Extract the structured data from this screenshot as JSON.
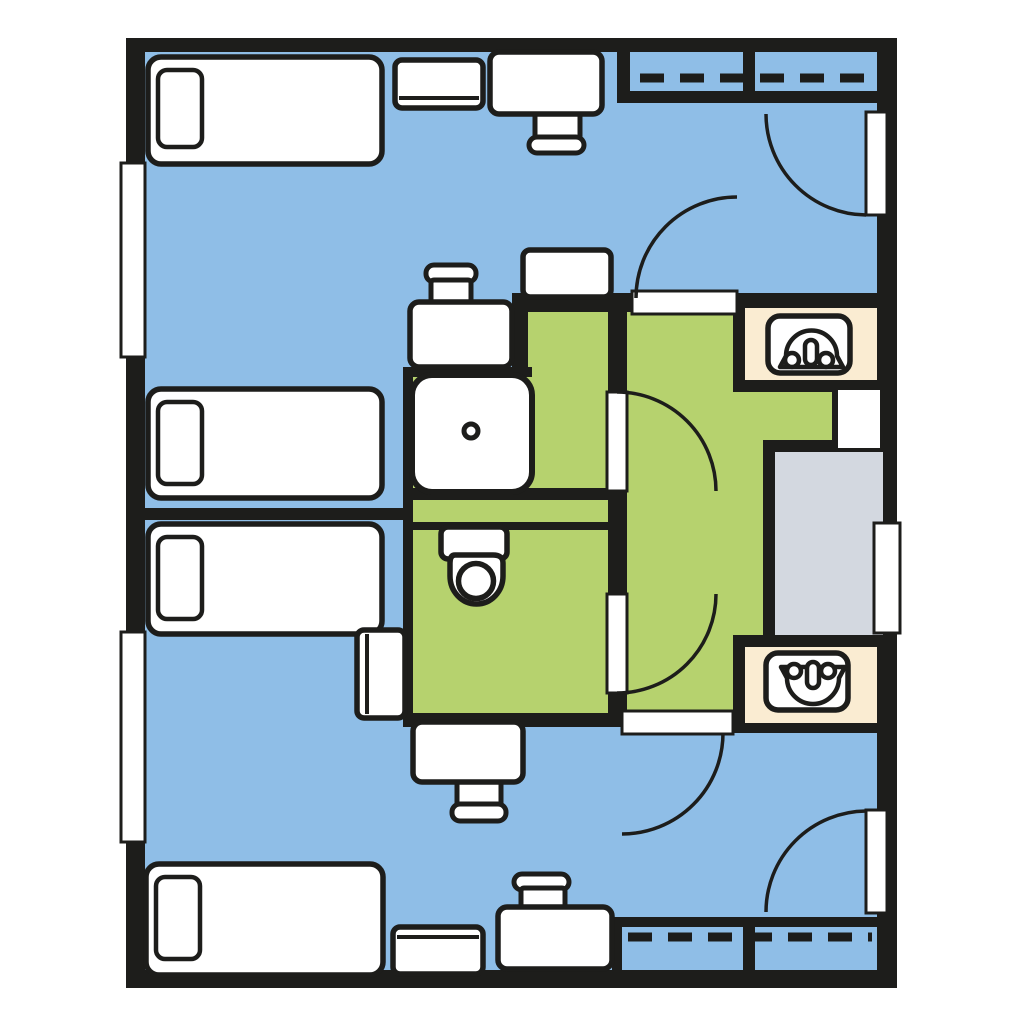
{
  "floor_plan": {
    "canvas": {
      "width": 1024,
      "height": 1024,
      "background": "#ffffff"
    },
    "colors": {
      "wall": "#1d1d1b",
      "bedroom": "#8fbee7",
      "bathroom": "#b6d26e",
      "vanity": "#faecd2",
      "shower_room": "#d3d8e0",
      "fixture": "#ffffff"
    },
    "floors": [
      {
        "name": "floor-bedroom-top-main",
        "color": "bedroom",
        "rect": [
          145,
          52,
          732,
          241
        ]
      },
      {
        "name": "floor-bedroom-top-left",
        "color": "bedroom",
        "rect": [
          145,
          293,
          258,
          215
        ]
      },
      {
        "name": "floor-bedroom-top-desk-nook",
        "color": "bedroom",
        "rect": [
          403,
          293,
          109,
          84
        ]
      },
      {
        "name": "floor-bedroom-bottom-left",
        "color": "bedroom",
        "rect": [
          145,
          520,
          258,
          193
        ]
      },
      {
        "name": "floor-bedroom-bottom-main",
        "color": "bedroom",
        "rect": [
          145,
          713,
          732,
          257
        ]
      },
      {
        "name": "floor-shower-room-green",
        "color": "bathroom",
        "rect": [
          528,
          312,
          99,
          180
        ]
      },
      {
        "name": "floor-shower-niche",
        "color": "bathroom",
        "rect": [
          408,
          377,
          124,
          115
        ]
      },
      {
        "name": "floor-plumbing-chase-strip",
        "color": "bathroom",
        "rect": [
          403,
          500,
          224,
          22
        ]
      },
      {
        "name": "floor-toilet-room",
        "color": "bathroom",
        "rect": [
          403,
          530,
          224,
          183
        ]
      },
      {
        "name": "floor-vestibule",
        "color": "bathroom",
        "rect": [
          627,
          303,
          250,
          410
        ]
      }
    ],
    "frames": [
      {
        "name": "vanity-top-frame",
        "rect": [
          733,
          296,
          164,
          96
        ]
      },
      {
        "name": "vanity-bottom-frame",
        "rect": [
          733,
          635,
          164,
          98
        ]
      },
      {
        "name": "shower-room-frame",
        "rect": [
          763,
          440,
          134,
          207
        ]
      }
    ],
    "walls": [
      {
        "name": "wall-top",
        "rect": [
          126,
          38,
          771,
          14
        ]
      },
      {
        "name": "wall-bottom",
        "rect": [
          126,
          970,
          771,
          18
        ]
      },
      {
        "name": "wall-left",
        "rect": [
          126,
          38,
          19,
          950
        ]
      },
      {
        "name": "wall-right",
        "rect": [
          877,
          38,
          20,
          950
        ]
      },
      {
        "name": "wall-closet-top-side",
        "rect": [
          617,
          45,
          13,
          58
        ]
      },
      {
        "name": "wall-closet-top-front",
        "rect": [
          617,
          91,
          260,
          12
        ]
      },
      {
        "name": "wall-closet-top-divider",
        "rect": [
          743,
          45,
          12,
          58
        ]
      },
      {
        "name": "wall-bath-north-left",
        "rect": [
          512,
          293,
          120,
          19
        ]
      },
      {
        "name": "wall-bath-north-right",
        "rect": [
          737,
          293,
          140,
          19
        ]
      },
      {
        "name": "wall-desk-nook",
        "rect": [
          512,
          293,
          16,
          84
        ]
      },
      {
        "name": "wall-shower-niche-north",
        "rect": [
          403,
          367,
          129,
          10
        ]
      },
      {
        "name": "wall-bath-west",
        "rect": [
          403,
          367,
          10,
          360
        ]
      },
      {
        "name": "wall-suite-divider",
        "rect": [
          126,
          508,
          287,
          12
        ]
      },
      {
        "name": "wall-chase-north",
        "rect": [
          403,
          488,
          224,
          12
        ]
      },
      {
        "name": "wall-chase-south",
        "rect": [
          403,
          522,
          224,
          8
        ]
      },
      {
        "name": "wall-bath-east-upper",
        "rect": [
          608,
          312,
          19,
          80
        ]
      },
      {
        "name": "wall-bath-east-mid",
        "rect": [
          608,
          490,
          19,
          105
        ]
      },
      {
        "name": "wall-bath-east-lower",
        "rect": [
          608,
          692,
          19,
          21
        ]
      },
      {
        "name": "wall-bath-south",
        "rect": [
          403,
          713,
          219,
          14
        ]
      },
      {
        "name": "wall-closet-bottom-side",
        "rect": [
          612,
          917,
          10,
          53
        ]
      },
      {
        "name": "wall-closet-bottom-front",
        "rect": [
          612,
          917,
          265,
          10
        ]
      },
      {
        "name": "wall-closet-bottom-divider",
        "rect": [
          743,
          917,
          12,
          53
        ]
      },
      {
        "name": "wall-shower-entry-edge",
        "rect": [
          832,
          388,
          6,
          62
        ]
      }
    ],
    "insets": [
      {
        "name": "vanity-top-counter",
        "color": "vanity",
        "rect": [
          745,
          308,
          132,
          72
        ]
      },
      {
        "name": "vanity-bottom-counter",
        "color": "vanity",
        "rect": [
          745,
          647,
          132,
          76
        ]
      },
      {
        "name": "shower-room-floor",
        "color": "shower_room",
        "rect": [
          775,
          452,
          108,
          183
        ]
      }
    ],
    "openings": [
      {
        "name": "window-left-upper",
        "rect": [
          121,
          163,
          24,
          194
        ],
        "sw": 3
      },
      {
        "name": "window-left-lower",
        "rect": [
          121,
          632,
          24,
          210
        ],
        "sw": 3
      },
      {
        "name": "window-right",
        "rect": [
          874,
          523,
          26,
          110
        ],
        "sw": 3
      },
      {
        "name": "entry-door-top-gap",
        "rect": [
          866,
          112,
          21,
          103
        ],
        "sw": 3
      },
      {
        "name": "entry-door-bottom-gap",
        "rect": [
          866,
          810,
          21,
          103
        ],
        "sw": 3
      },
      {
        "name": "doorway-top-bedroom",
        "rect": [
          632,
          291,
          105,
          23
        ],
        "sw": 3
      },
      {
        "name": "doorway-bottom-bedroom",
        "rect": [
          622,
          711,
          111,
          23
        ],
        "sw": 3
      },
      {
        "name": "door-leaf-shower-room",
        "rect": [
          607,
          392,
          20,
          99
        ],
        "sw": 3
      },
      {
        "name": "door-leaf-toilet-room",
        "rect": [
          607,
          594,
          20,
          99
        ],
        "sw": 3
      },
      {
        "name": "shower-room-entry",
        "rect": [
          838,
          390,
          42,
          58
        ],
        "sw": 0
      }
    ],
    "door_arcs": [
      {
        "name": "arc-entry-door-top",
        "d": "M 766 114 A 101 101 0 0 0 866 215"
      },
      {
        "name": "arc-top-bedroom-door",
        "d": "M 737 197 A 101 101 0 0 0 636 298"
      },
      {
        "name": "arc-shower-room-door",
        "d": "M 617 392 A 99 99 0 0 1 716 491"
      },
      {
        "name": "arc-toilet-room-door",
        "d": "M 617 693 A 99 99 0 0 0 716 594"
      },
      {
        "name": "arc-bottom-bedroom-door",
        "d": "M 723 733 A 101 101 0 0 1 622 834"
      },
      {
        "name": "arc-entry-door-bottom",
        "d": "M 766 912 A 101 101 0 0 1 866 811"
      }
    ],
    "closet_rods": [
      {
        "name": "closet-rod-top",
        "x1": 640,
        "y1": 78,
        "x2": 872,
        "y2": 78
      },
      {
        "name": "closet-rod-bottom",
        "x1": 628,
        "y1": 937,
        "x2": 872,
        "y2": 937
      }
    ],
    "furniture": [
      {
        "name": "bed-1",
        "rect": [
          148,
          57,
          234,
          107
        ],
        "rx": 13
      },
      {
        "name": "bed-1-pillow",
        "rect": [
          158,
          70,
          44,
          77
        ],
        "rx": 9,
        "sw": 4.5
      },
      {
        "name": "bed-2",
        "rect": [
          148,
          389,
          234,
          109
        ],
        "rx": 13
      },
      {
        "name": "bed-2-pillow",
        "rect": [
          158,
          402,
          44,
          82
        ],
        "rx": 9,
        "sw": 4.5
      },
      {
        "name": "bed-3",
        "rect": [
          148,
          524,
          234,
          110
        ],
        "rx": 13
      },
      {
        "name": "bed-3-pillow",
        "rect": [
          158,
          537,
          44,
          82
        ],
        "rx": 9,
        "sw": 4.5
      },
      {
        "name": "bed-4",
        "rect": [
          146,
          864,
          237,
          111
        ],
        "rx": 13
      },
      {
        "name": "bed-4-pillow",
        "rect": [
          156,
          877,
          44,
          82
        ],
        "rx": 9,
        "sw": 4.5
      },
      {
        "name": "table-top-wall",
        "rect": [
          395,
          60,
          88,
          48
        ],
        "rx": 7,
        "edge": "bottom"
      },
      {
        "name": "chair-desk-top-seat",
        "rect": [
          535,
          112,
          45,
          27
        ],
        "rx": 3,
        "sw": 5
      },
      {
        "name": "desk-top-wall",
        "rect": [
          490,
          52,
          112,
          62
        ],
        "rx": 9
      },
      {
        "name": "chair-desk-top-back",
        "rect": [
          529,
          137,
          55,
          16
        ],
        "rx": 8,
        "sw": 5
      },
      {
        "name": "dresser-mid-top",
        "rect": [
          523,
          250,
          88,
          47
        ],
        "rx": 7
      },
      {
        "name": "chair-desk-nook-top-back",
        "rect": [
          426,
          265,
          50,
          17
        ],
        "rx": 8,
        "sw": 5
      },
      {
        "name": "chair-desk-nook-top-seat",
        "rect": [
          431,
          280,
          40,
          25
        ],
        "rx": 3,
        "sw": 5
      },
      {
        "name": "desk-nook-top",
        "rect": [
          410,
          302,
          102,
          65
        ],
        "rx": 9
      },
      {
        "name": "nightstand-mid-bottom",
        "rect": [
          357,
          630,
          48,
          88
        ],
        "rx": 7,
        "edge": "left"
      },
      {
        "name": "chair-desk-nook-bottom-seat",
        "rect": [
          457,
          781,
          44,
          26
        ],
        "rx": 3,
        "sw": 5
      },
      {
        "name": "desk-nook-bottom",
        "rect": [
          413,
          722,
          110,
          60
        ],
        "rx": 9
      },
      {
        "name": "chair-desk-nook-bottom-back",
        "rect": [
          452,
          804,
          54,
          17
        ],
        "rx": 8,
        "sw": 5
      },
      {
        "name": "chair-desk-bottom-back",
        "rect": [
          514,
          874,
          55,
          16
        ],
        "rx": 8,
        "sw": 5
      },
      {
        "name": "chair-desk-bottom-seat",
        "rect": [
          521,
          888,
          44,
          23
        ],
        "rx": 3,
        "sw": 5
      },
      {
        "name": "desk-bottom-wall",
        "rect": [
          498,
          907,
          114,
          62
        ],
        "rx": 9
      },
      {
        "name": "table-bottom-wall",
        "rect": [
          393,
          927,
          90,
          47
        ],
        "rx": 7,
        "edge": "top"
      }
    ],
    "fixtures": [
      {
        "name": "shower-stall",
        "parts": [
          {
            "type": "rect",
            "x": 412,
            "y": 375,
            "w": 120,
            "h": 117,
            "rx": 20,
            "sw": 6
          },
          {
            "type": "circle",
            "cx": 471,
            "cy": 431,
            "r": 7,
            "sw": 5
          }
        ]
      },
      {
        "name": "toilet",
        "parts": [
          {
            "type": "rect",
            "x": 441,
            "y": 527,
            "w": 66,
            "h": 32,
            "rx": 7,
            "sw": 5.5
          },
          {
            "type": "path",
            "d": "M 455 555 H 493 Q 503 555 503 563 V 576 A 26.5 28 0 0 1 450 576 V 563 Q 450 555 455 555 Z",
            "sw": 5.5
          },
          {
            "type": "circle",
            "cx": 476,
            "cy": 581,
            "r": 17.5,
            "sw": 5.5
          }
        ]
      },
      {
        "name": "sink-top",
        "parts": [
          {
            "type": "rect",
            "x": 768,
            "y": 316,
            "w": 82,
            "h": 57,
            "rx": 12,
            "sw": 5.5
          },
          {
            "type": "path",
            "d": "M 786 356 A 25.5 25.5 0 0 1 837 356 L 843 367 L 780 367 Z",
            "sw": 4.5
          },
          {
            "type": "rect",
            "x": 805,
            "y": 340,
            "w": 12,
            "h": 25,
            "rx": 6,
            "sw": 4.5
          },
          {
            "type": "circle",
            "cx": 792,
            "cy": 360,
            "r": 7,
            "sw": 4.5
          },
          {
            "type": "circle",
            "cx": 826,
            "cy": 360,
            "r": 7,
            "sw": 4.5
          }
        ]
      },
      {
        "name": "sink-bottom",
        "parts": [
          {
            "type": "rect",
            "x": 766,
            "y": 653,
            "w": 82,
            "h": 57,
            "rx": 12,
            "sw": 5.5
          },
          {
            "type": "path",
            "d": "M 787 678 A 26 26 0 0 0 839 678 L 845 667 L 781 667 Z",
            "sw": 4.5
          },
          {
            "type": "rect",
            "x": 807,
            "y": 662,
            "w": 12,
            "h": 26,
            "rx": 6,
            "sw": 4.5
          },
          {
            "type": "circle",
            "cx": 794,
            "cy": 671,
            "r": 7,
            "sw": 4.5
          },
          {
            "type": "circle",
            "cx": 828,
            "cy": 671,
            "r": 7,
            "sw": 4.5
          }
        ]
      }
    ]
  }
}
